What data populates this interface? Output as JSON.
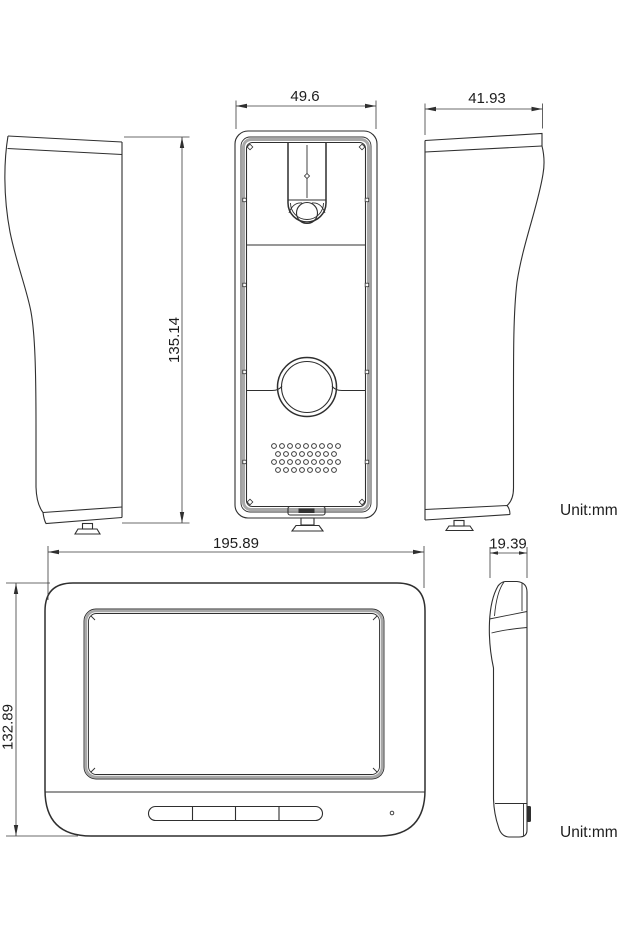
{
  "drawing": {
    "type": "technical-dimension-drawing",
    "product": "video-intercom doorbell and indoor monitor",
    "unit_top": "Unit:mm",
    "unit_bottom": "Unit:mm"
  },
  "doorbell": {
    "front_width_mm": "49.6",
    "side_width_mm": "41.93",
    "height_mm": "135.14"
  },
  "monitor": {
    "width_mm": "195.89",
    "height_mm": "132.89",
    "depth_mm": "19.39"
  }
}
